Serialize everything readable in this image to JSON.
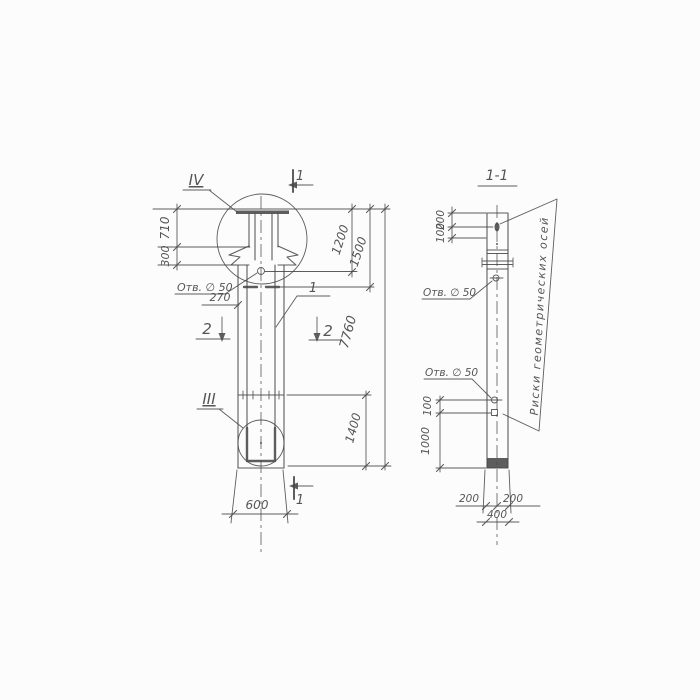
{
  "app": {
    "type": "technical-drawing",
    "bg": "#fcfcfc",
    "ink": "#474747"
  },
  "labels": {
    "section_title": "1-1",
    "detail_top": "IV",
    "detail_bottom": "III",
    "cut_mark": "1",
    "cut_mark_2": "2",
    "part_callout": "1",
    "hole_note": "Отв. ∅ 50",
    "axes_note": "Риски геометрических осей"
  },
  "front_dims": {
    "cap_height": "710",
    "anchor_height": "300",
    "top_to_hole": "1200",
    "top_to_collar": "1500",
    "total_length": "7760",
    "hole_offset": "270",
    "bottom_segment": "1400",
    "width": "600"
  },
  "section_dims": {
    "top_to_hole": "200",
    "hole_to_joint": "100",
    "hole_to_mark": "100",
    "mark_to_bottom": "1000",
    "half_width_left": "200",
    "half_width_right": "200",
    "width": "400"
  }
}
